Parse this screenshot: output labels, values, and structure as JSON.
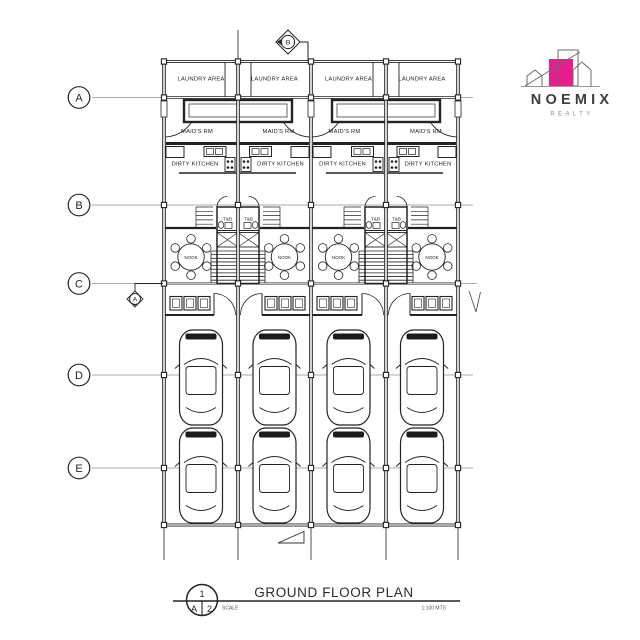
{
  "page": {
    "bg": "#ffffff",
    "ink": "#232323",
    "grid_ink": "#8f8f8f"
  },
  "logo": {
    "name": "NOEMIX",
    "tagline": "REALTY",
    "accent": "#E81C8E"
  },
  "grid": {
    "row_labels": [
      "A",
      "B",
      "C",
      "D",
      "E"
    ]
  },
  "markers": {
    "top_section": "B",
    "left_section": "A"
  },
  "rooms": {
    "laundry": "LAUNDRY AREA",
    "maids": "MAID'S RM",
    "kitchen": "DIRTY KITCHEN",
    "bath": "T&B",
    "nook": "NOOK"
  },
  "plan_facts": {
    "unit_count": 4,
    "car_count": 8
  },
  "title_block": {
    "title": "GROUND FLOOR PLAN",
    "scale_label": "SCALE",
    "scale_value": "1:100 MTS",
    "ref_top": "1",
    "ref_left": "A",
    "ref_right": "2"
  }
}
